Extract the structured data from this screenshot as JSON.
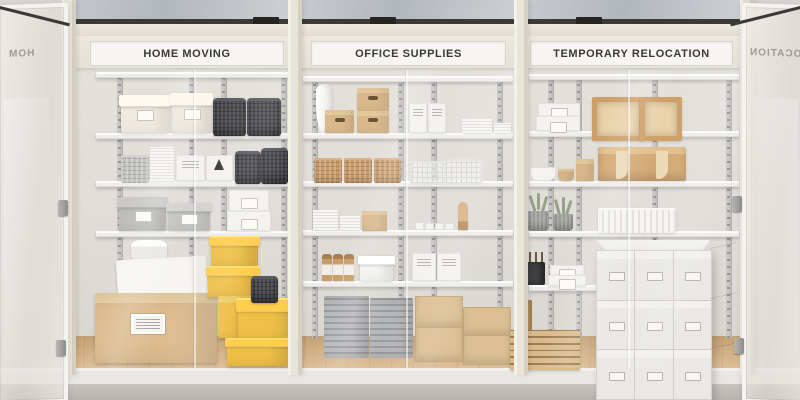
{
  "scene": {
    "description": "Self-storage room: three glass-front shelving bays with category signs, doors open at both ends",
    "signs": [
      {
        "id": "home-moving",
        "label": "HOME MOVING"
      },
      {
        "id": "office-supplies",
        "label": "OFFICE SUPPLIES"
      },
      {
        "id": "temporary-relocation",
        "label": "TEMPORARY RELOCATION"
      }
    ],
    "door_reflections": {
      "left": "HOM",
      "right": "OCATION"
    },
    "sections": [
      {
        "name": "home-moving",
        "items": [
          "cream lidded boxes",
          "dark woven baskets",
          "white label boxes",
          "gray lidded boxes",
          "white flat document boxes",
          "round hat box",
          "white carton",
          "large kraft moving box with label",
          "stack of yellow gift boxes",
          "small black basket"
        ]
      },
      {
        "name": "office-supplies",
        "items": [
          "white vase",
          "kraft handle boxes",
          "white file boxes",
          "paper stacks",
          "rattan baskets",
          "white wire baskets",
          "book stacks",
          "small canisters",
          "wooden mannequin hand",
          "amber bottles",
          "white lidded box",
          "gray letter-tray stacks",
          "kraft drawer boxes"
        ]
      },
      {
        "name": "temporary-relocation",
        "items": [
          "white flat boxes",
          "wooden open organizers",
          "bowls and pots",
          "wooden desk organizer",
          "potted plants",
          "white corrugated box",
          "pen cup with tools",
          "wooden pallets",
          "stack of nine white moving boxes"
        ]
      }
    ],
    "colors": {
      "wall": "#e0ddd8",
      "frame_cream": "#e9e4d8",
      "sign_plate": "#f6f5f1",
      "sign_text": "#3a3938",
      "shelf_white": "#f4f3f1",
      "upright_gray": "#c6c5c2",
      "basket_dark": "#45454a",
      "rattan_tan": "#c89a69",
      "kraft": "#d9b88b",
      "accent_yellow": "#efc047",
      "wood_floor": "#cfae82",
      "glass_tint": "#b6bac0",
      "concrete": "#bfbcb8"
    }
  }
}
